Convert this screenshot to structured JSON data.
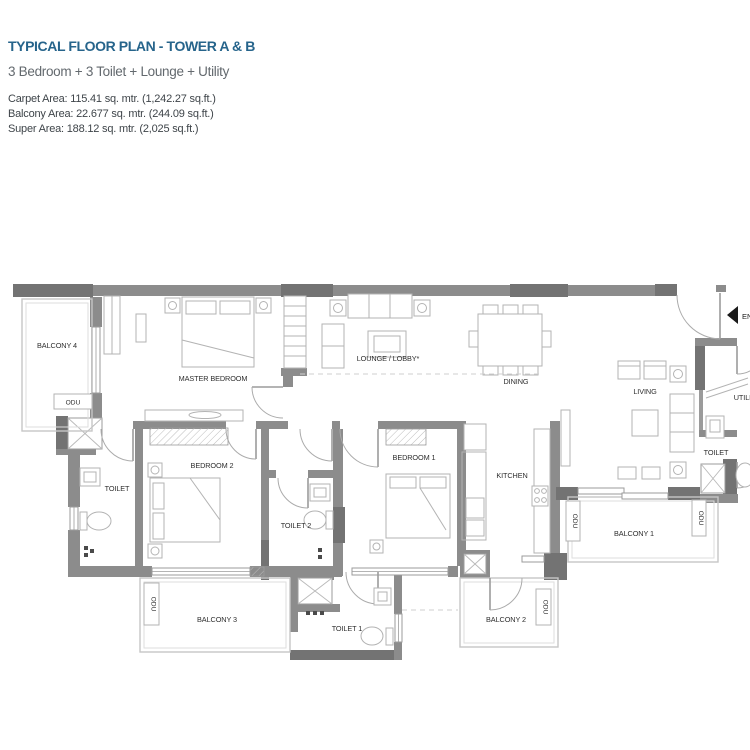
{
  "header": {
    "title": "TYPICAL FLOOR PLAN - TOWER A & B",
    "subtitle": "3 Bedroom + 3 Toilet + Lounge + Utility",
    "carpet_area": "Carpet Area: 115.41 sq. mtr. (1,242.27 sq.ft.)",
    "balcony_area": "Balcony Area: 22.677 sq. mtr. (244.09 sq.ft.)",
    "super_area": "Super Area: 188.12 sq. mtr. (2,025 sq.ft.)"
  },
  "plan": {
    "rooms": {
      "master_bedroom": "MASTER BEDROOM",
      "lounge": "LOUNGE / LOBBY*",
      "dining": "DINING",
      "living": "LIVING",
      "bedroom_1": "BEDROOM 1",
      "bedroom_2": "BEDROOM 2",
      "kitchen": "KITCHEN",
      "toilet": "TOILET",
      "toilet_1": "TOILET 1",
      "toilet_2": "TOILET 2",
      "utility": "UTILITY",
      "balcony_1": "BALCONY 1",
      "balcony_2": "BALCONY 2",
      "balcony_3": "BALCONY 3",
      "balcony_4": "BALCONY 4",
      "entry": "ENTRY",
      "odu": "ODU"
    },
    "colors": {
      "title_blue": "#26648B",
      "wall_gray": "#8C8C8C",
      "column_gray": "#737373",
      "entry_arrow_black": "#1a1a1a"
    }
  }
}
